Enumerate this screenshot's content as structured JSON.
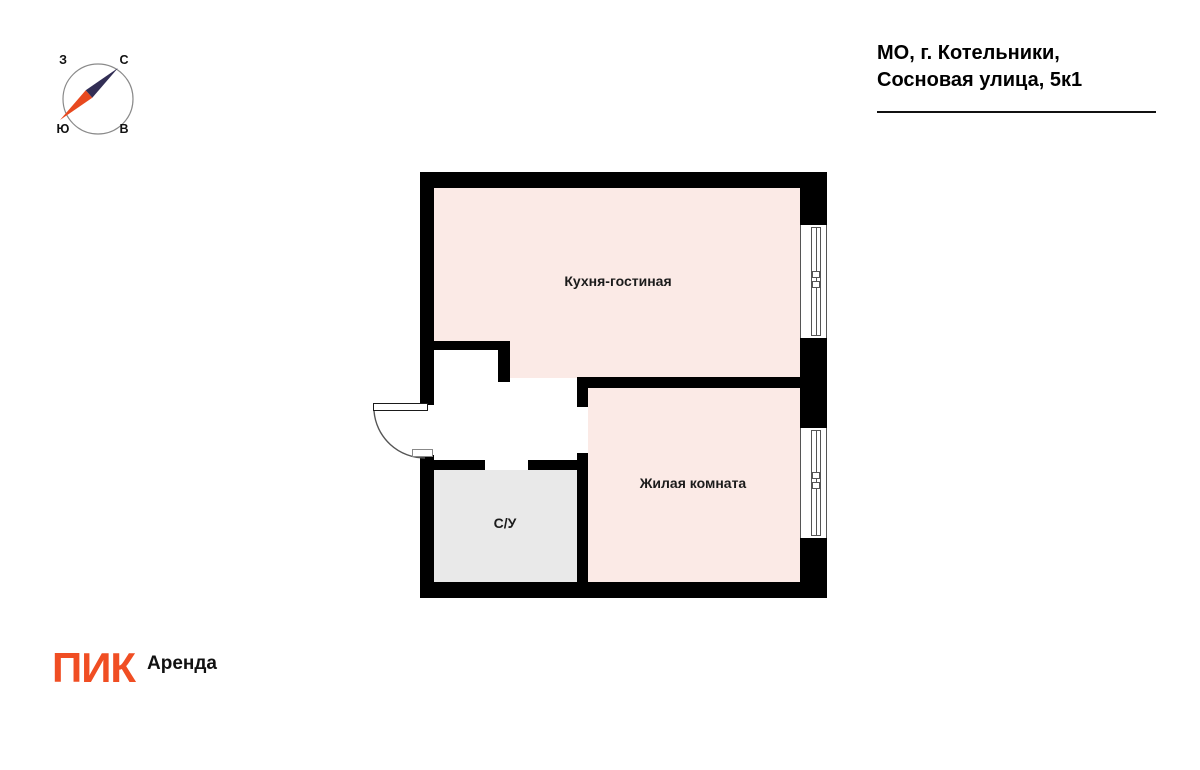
{
  "header": {
    "address_line1": "МО, г. Котельники,",
    "address_line2": "Сосновая улица, 5к1"
  },
  "compass": {
    "west": "З",
    "north": "С",
    "south": "Ю",
    "east": "В"
  },
  "floorplan": {
    "rooms": [
      {
        "id": "kitchen-living",
        "label": "Кухня-гостиная"
      },
      {
        "id": "living-room",
        "label": "Жилая комната"
      },
      {
        "id": "bathroom",
        "label": "С/У"
      }
    ]
  },
  "footer": {
    "brand": "ПИК",
    "product": "Аренда"
  },
  "colors": {
    "brand_orange": "#f04e23",
    "floor_pink": "#fbeae6",
    "floor_gray": "#e9e9e9",
    "wall_black": "#000000",
    "needle_navy": "#322e55",
    "needle_orange": "#e8491f",
    "compass_ring": "#8a8a8a"
  }
}
